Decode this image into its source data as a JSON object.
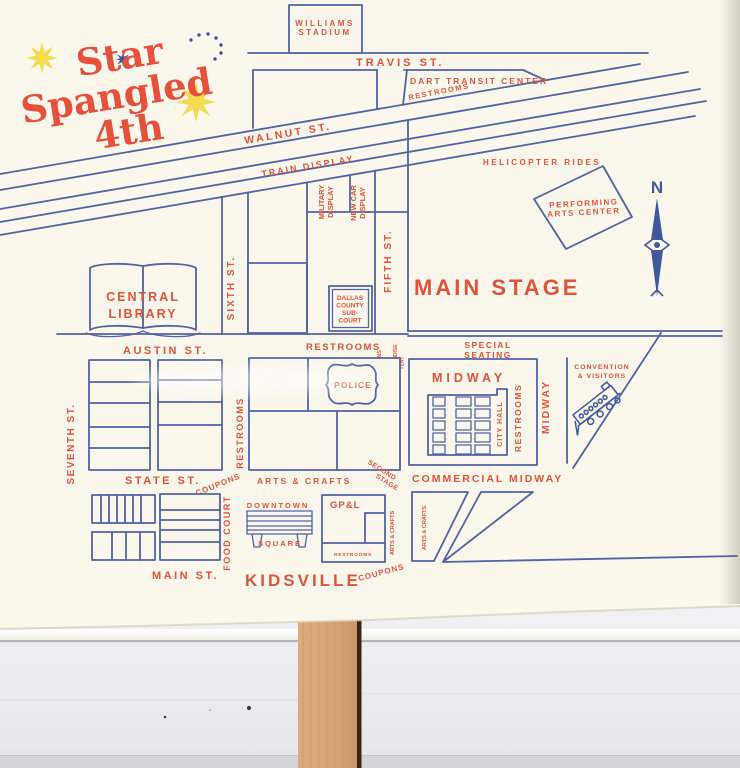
{
  "title": {
    "star": "Star",
    "spangled": "Spangled",
    "fourth": "4th"
  },
  "compass": {
    "north": "N"
  },
  "colors": {
    "blue": "#5164a4",
    "red": "#e0543a",
    "yellow": "#f2dd4e",
    "paper": "#fbf7ec"
  },
  "streets": {
    "travis": "TRAVIS ST.",
    "walnut": "WALNUT ST.",
    "austin": "AUSTIN ST.",
    "state": "STATE ST.",
    "main": "MAIN ST.",
    "fifth": "FIFTH ST.",
    "sixth": "SIXTH ST.",
    "seventh": "SEVENTH ST.",
    "commercial_midway": "COMMERCIAL MIDWAY",
    "midway": "MIDWAY"
  },
  "venues": {
    "williams_stadium": {
      "line1": "WILLIAMS",
      "line2": "STADIUM"
    },
    "dart": {
      "name": "DART TRANSIT CENTER",
      "restrooms": "RESTROOMS"
    },
    "train_display": "TRAIN DISPLAY",
    "helicopter": "HELICOPTER RIDES",
    "pac": {
      "line1": "PERFORMING",
      "line2": "ARTS CENTER"
    },
    "military": {
      "line1": "MILITARY",
      "line2": "DISPLAY"
    },
    "new_car": {
      "line1": "NEW CAR",
      "line2": "DISPLAY"
    },
    "library": {
      "line1": "CENTRAL",
      "line2": "LIBRARY"
    },
    "main_stage": "MAIN STAGE",
    "sub_court": {
      "line1": "DALLAS",
      "line2": "COUNTY",
      "line3": "SUB-",
      "line4": "COURT"
    },
    "restrooms_court": "RESTROOMS",
    "coupons_info": {
      "line1": "COUPONS",
      "line2": "INFO"
    },
    "merch_tent": {
      "line1": "MERCHANDISE",
      "line2": "TENT"
    },
    "sponsors": "SPONSORS",
    "special_seating": {
      "line1": "SPECIAL",
      "line2": "SEATING"
    },
    "midway_area": "MIDWAY",
    "city_hall": "CITY HALL",
    "restrooms_midway": "RESTROOMS",
    "convention": {
      "line1": "CONVENTION",
      "line2": "& VISITORS"
    },
    "police": "POLICE",
    "restrooms_left": "RESTROOMS",
    "coupons_state": "COUPONS",
    "arts_crafts_state": "ARTS & CRAFTS",
    "second_stage": {
      "line1": "SECOND",
      "line2": "STAGE"
    },
    "food_court": "FOOD COURT",
    "downtown_square": {
      "line1": "DOWNTOWN",
      "line2": "SQUARE"
    },
    "gpl": {
      "name": "GP&L",
      "restrooms": "RESTROOMS"
    },
    "arts_crafts_v1": "ARTS & CRAFTS",
    "arts_crafts_v2": "ARTS & CRAFTS",
    "kidsville": "KIDSVILLE",
    "coupons_kidsville": "COUPONS"
  }
}
